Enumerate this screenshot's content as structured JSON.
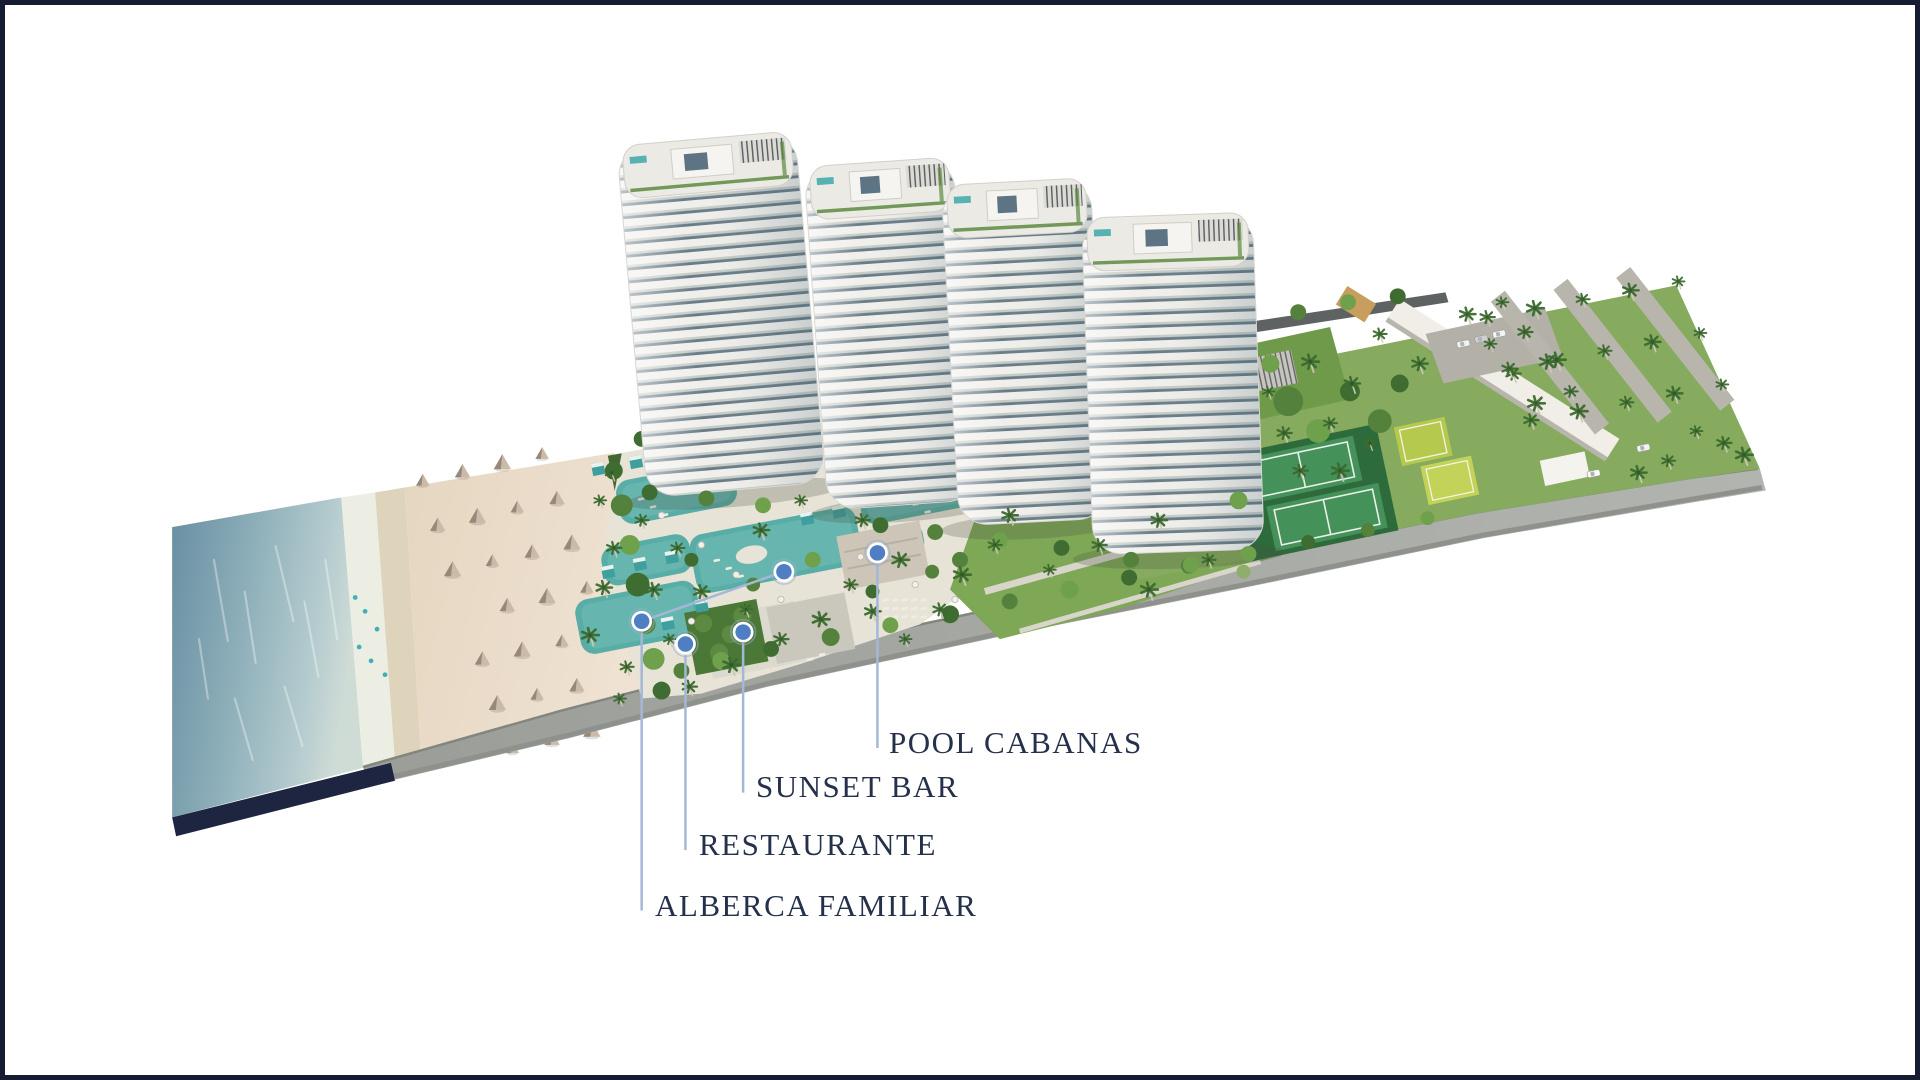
{
  "page": {
    "background_color": "#ffffff",
    "frame_border_color": "#151b31"
  },
  "callouts": {
    "text_color": "#25304a",
    "line_color": "#a3b8d7",
    "marker_fill_color": "#4f7fc2",
    "marker_ring_color": "#ffffff",
    "items": [
      {
        "id": "pool-cabanas",
        "label": "POOL CABANAS",
        "marker": {
          "x": 877,
          "y": 553
        },
        "label_pos": {
          "x": 884,
          "y": 722
        },
        "line_bottom_y": 750
      },
      {
        "id": "sunset-bar",
        "label": "SUNSET BAR",
        "marker": {
          "x": 742,
          "y": 633
        },
        "label_pos": {
          "x": 751,
          "y": 766
        },
        "line_bottom_y": 795
      },
      {
        "id": "restaurante",
        "label": "RESTAURANTE",
        "marker": {
          "x": 684,
          "y": 645
        },
        "label_pos": {
          "x": 694,
          "y": 824
        },
        "line_bottom_y": 853
      },
      {
        "id": "alberca-familiar",
        "label": "ALBERCA FAMILIAR",
        "marker": {
          "x": 640,
          "y": 622
        },
        "secondary_marker": {
          "x": 783,
          "y": 572
        },
        "label_pos": {
          "x": 650,
          "y": 885
        },
        "line_bottom_y": 914
      }
    ]
  },
  "scene": {
    "type": "aerial-rendering",
    "features": [
      "ocean",
      "beach",
      "beach-palapas",
      "pool-deck",
      "residential-towers",
      "tennis-courts",
      "paddle-courts",
      "palm-grove",
      "perimeter-road"
    ]
  }
}
